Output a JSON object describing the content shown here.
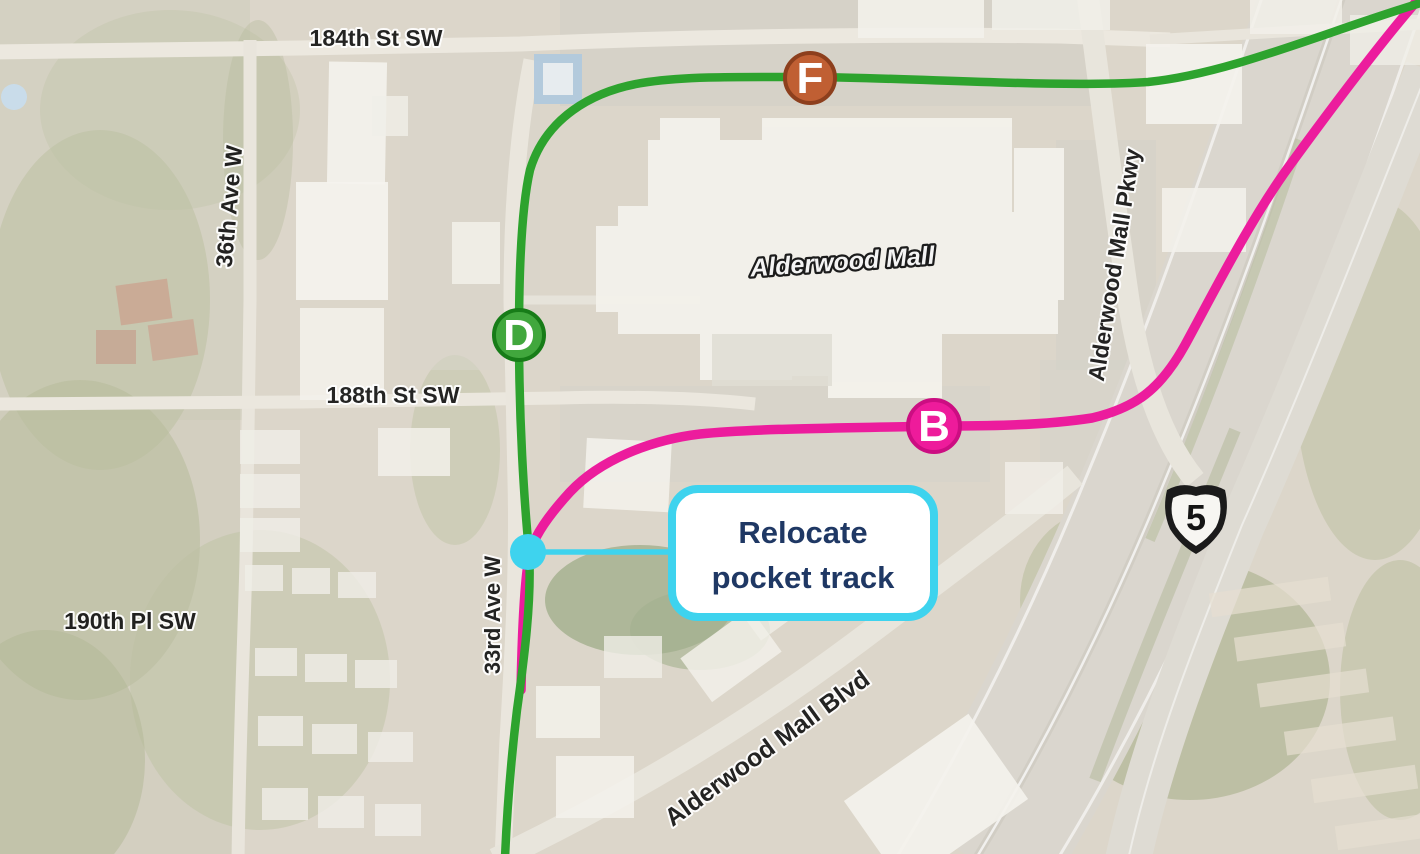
{
  "map": {
    "street_labels": {
      "st184": "184th St SW",
      "ave36": "36th Ave W",
      "st188": "188th St SW",
      "pl190": "190th Pl SW",
      "ave33": "33rd Ave W",
      "pkwy": "Alderwood Mall Pkwy",
      "blvd": "Alderwood Mall Blvd"
    },
    "place_labels": {
      "mall": "Alderwood Mall"
    },
    "highway_shield": {
      "number": "5"
    },
    "routes": {
      "green": {
        "color": "#2da32e"
      },
      "pink": {
        "color": "#ec1c9d"
      }
    },
    "route_markers": {
      "f": {
        "label": "F",
        "fill": "#c05f33",
        "stroke": "#8d3f1d"
      },
      "d": {
        "label": "D",
        "fill": "#41a73d",
        "stroke": "#177c18"
      },
      "b": {
        "label": "B",
        "fill": "#ee1b9b",
        "stroke": "#cc0d82"
      }
    },
    "callout": {
      "line1": "Relocate",
      "line2": "pocket track",
      "accent_color": "#3ed3ee",
      "text_color": "#1f3864"
    }
  }
}
